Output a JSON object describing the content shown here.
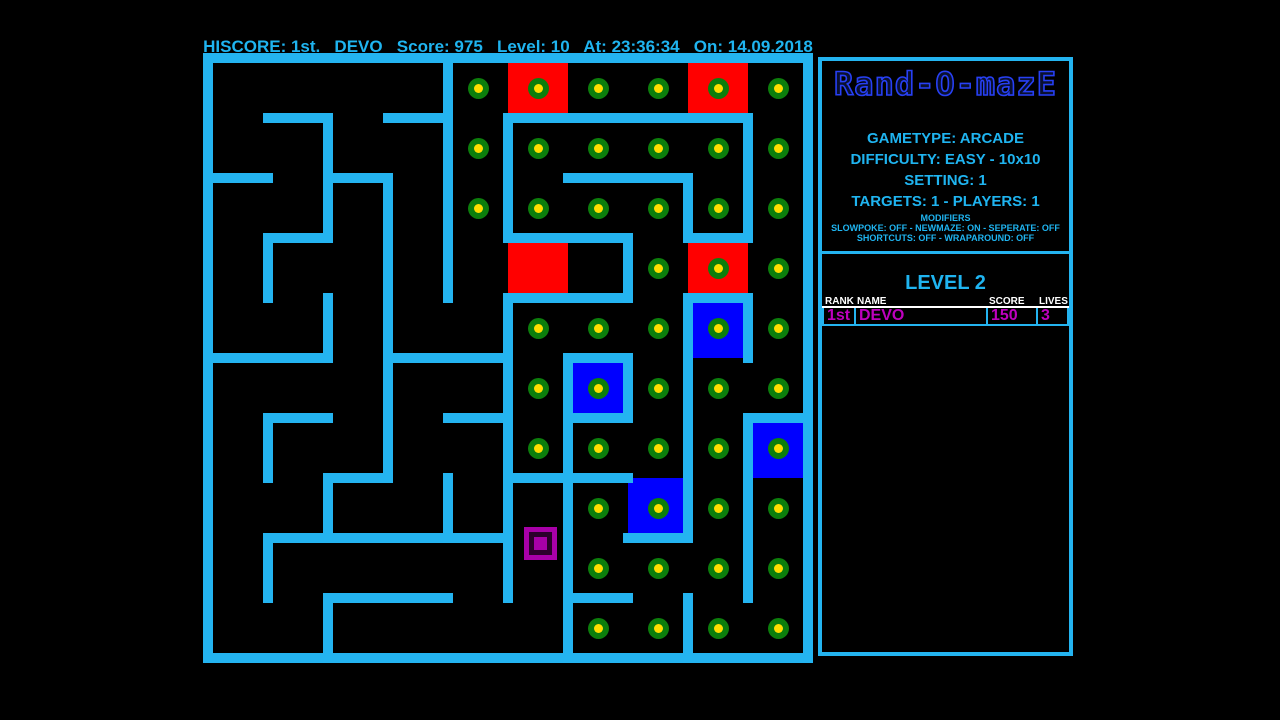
{
  "header": {
    "text": "HISCORE: 1st.   DEVO   Score: 975   Level: 10   At: 23:36:34   On: 14.09.2018"
  },
  "colors": {
    "wall_cyan": "#24B4F0",
    "text_cyan": "#1FB4F0",
    "red_cell": "#FF0000",
    "blue_cell": "#0000FF",
    "pellet_ring_green": "#0C7E0C",
    "pellet_core_yellow": "#FFDE00",
    "score_magenta": "#BE00BE",
    "player_magenta": "#A800A8",
    "logo_blue": "#2740F5",
    "white": "#FFFFFF",
    "background": "#000000"
  },
  "maze": {
    "cols": 10,
    "rows": 10,
    "cell_px": 60,
    "wall_px": 10,
    "origin_x": 203,
    "origin_y": 53,
    "walls_h": [
      {
        "r": 0,
        "c0": 0,
        "c1": 10
      },
      {
        "r": 1,
        "c0": 1,
        "c1": 2
      },
      {
        "r": 1,
        "c0": 3,
        "c1": 4
      },
      {
        "r": 1,
        "c0": 5,
        "c1": 9
      },
      {
        "r": 2,
        "c0": 0,
        "c1": 1
      },
      {
        "r": 2,
        "c0": 2,
        "c1": 3
      },
      {
        "r": 2,
        "c0": 6,
        "c1": 8
      },
      {
        "r": 3,
        "c0": 1,
        "c1": 2
      },
      {
        "r": 3,
        "c0": 5,
        "c1": 7
      },
      {
        "r": 3,
        "c0": 8,
        "c1": 9
      },
      {
        "r": 4,
        "c0": 5,
        "c1": 7
      },
      {
        "r": 4,
        "c0": 8,
        "c1": 9
      },
      {
        "r": 5,
        "c0": 0,
        "c1": 2
      },
      {
        "r": 5,
        "c0": 3,
        "c1": 5
      },
      {
        "r": 5,
        "c0": 6,
        "c1": 7
      },
      {
        "r": 6,
        "c0": 1,
        "c1": 2
      },
      {
        "r": 6,
        "c0": 4,
        "c1": 5
      },
      {
        "r": 6,
        "c0": 6,
        "c1": 7
      },
      {
        "r": 6,
        "c0": 9,
        "c1": 10
      },
      {
        "r": 7,
        "c0": 2,
        "c1": 3
      },
      {
        "r": 7,
        "c0": 5,
        "c1": 7
      },
      {
        "r": 8,
        "c0": 1,
        "c1": 5
      },
      {
        "r": 8,
        "c0": 7,
        "c1": 8
      },
      {
        "r": 9,
        "c0": 2,
        "c1": 4
      },
      {
        "r": 9,
        "c0": 6,
        "c1": 7
      },
      {
        "r": 10,
        "c0": 0,
        "c1": 10
      }
    ],
    "walls_v": [
      {
        "c": 0,
        "r0": 0,
        "r1": 10
      },
      {
        "c": 10,
        "r0": 0,
        "r1": 10
      },
      {
        "c": 4,
        "r0": 0,
        "r1": 4
      },
      {
        "c": 2,
        "r0": 1,
        "r1": 3
      },
      {
        "c": 5,
        "r0": 1,
        "r1": 3
      },
      {
        "c": 9,
        "r0": 1,
        "r1": 3
      },
      {
        "c": 3,
        "r0": 2,
        "r1": 7
      },
      {
        "c": 8,
        "r0": 2,
        "r1": 3
      },
      {
        "c": 1,
        "r0": 3,
        "r1": 4
      },
      {
        "c": 7,
        "r0": 3,
        "r1": 4
      },
      {
        "c": 2,
        "r0": 4,
        "r1": 5
      },
      {
        "c": 5,
        "r0": 4,
        "r1": 9
      },
      {
        "c": 8,
        "r0": 4,
        "r1": 8
      },
      {
        "c": 9,
        "r0": 4,
        "r1": 5
      },
      {
        "c": 6,
        "r0": 5,
        "r1": 10
      },
      {
        "c": 7,
        "r0": 5,
        "r1": 6
      },
      {
        "c": 1,
        "r0": 6,
        "r1": 7
      },
      {
        "c": 9,
        "r0": 6,
        "r1": 9
      },
      {
        "c": 2,
        "r0": 7,
        "r1": 8
      },
      {
        "c": 4,
        "r0": 7,
        "r1": 8
      },
      {
        "c": 1,
        "r0": 8,
        "r1": 9
      },
      {
        "c": 2,
        "r0": 9,
        "r1": 10
      },
      {
        "c": 8,
        "r0": 9,
        "r1": 10
      }
    ],
    "red_cells": [
      [
        5,
        0
      ],
      [
        8,
        0
      ],
      [
        5,
        3
      ],
      [
        8,
        3
      ]
    ],
    "blue_cells": [
      [
        8,
        4
      ],
      [
        6,
        5
      ],
      [
        9,
        6
      ],
      [
        7,
        7
      ]
    ],
    "pellets": [
      [
        4,
        0
      ],
      [
        5,
        0
      ],
      [
        6,
        0
      ],
      [
        7,
        0
      ],
      [
        8,
        0
      ],
      [
        9,
        0
      ],
      [
        4,
        1
      ],
      [
        5,
        1
      ],
      [
        6,
        1
      ],
      [
        7,
        1
      ],
      [
        8,
        1
      ],
      [
        9,
        1
      ],
      [
        4,
        2
      ],
      [
        5,
        2
      ],
      [
        6,
        2
      ],
      [
        7,
        2
      ],
      [
        8,
        2
      ],
      [
        9,
        2
      ],
      [
        7,
        3
      ],
      [
        8,
        3
      ],
      [
        9,
        3
      ],
      [
        5,
        4
      ],
      [
        6,
        4
      ],
      [
        7,
        4
      ],
      [
        8,
        4
      ],
      [
        9,
        4
      ],
      [
        5,
        5
      ],
      [
        6,
        5
      ],
      [
        7,
        5
      ],
      [
        8,
        5
      ],
      [
        9,
        5
      ],
      [
        5,
        6
      ],
      [
        6,
        6
      ],
      [
        7,
        6
      ],
      [
        8,
        6
      ],
      [
        9,
        6
      ],
      [
        6,
        7
      ],
      [
        7,
        7
      ],
      [
        8,
        7
      ],
      [
        9,
        7
      ],
      [
        6,
        8
      ],
      [
        7,
        8
      ],
      [
        8,
        8
      ],
      [
        9,
        8
      ],
      [
        6,
        9
      ],
      [
        7,
        9
      ],
      [
        8,
        9
      ],
      [
        9,
        9
      ]
    ],
    "player": {
      "abs_x": 524,
      "abs_y": 527,
      "size": 33
    }
  },
  "sidebar": {
    "logo": "Rand-O-mazE",
    "info_lines": [
      "GAMETYPE: ARCADE",
      "DIFFICULTY: EASY - 10x10",
      "SETTING: 1",
      "TARGETS: 1 - PLAYERS: 1"
    ],
    "modifiers_title": "MODIFIERS",
    "modifier_lines": [
      "SLOWPOKE: OFF - NEWMAZE: ON - SEPERATE: OFF",
      "SHORTCUTS: OFF - WRAPAROUND: OFF"
    ],
    "level_title": "LEVEL 2",
    "table": {
      "headers": [
        "RANK",
        "NAME",
        "SCORE",
        "LIVES"
      ],
      "rows": [
        [
          "1st",
          "DEVO",
          "150",
          "3"
        ]
      ]
    }
  }
}
